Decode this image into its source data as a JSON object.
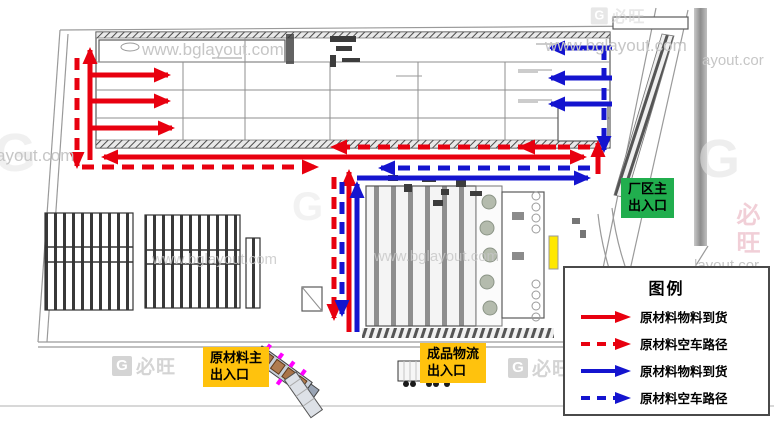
{
  "labels": {
    "main_gate": {
      "line1": "厂区主",
      "line2": "出入口"
    },
    "raw_material_gate": {
      "line1": "原材料主",
      "line2": "出入口"
    },
    "finished_goods_gate": {
      "line1": "成品物流",
      "line2": "出入口"
    }
  },
  "legend": {
    "title": "图例",
    "items": [
      {
        "label": "原材料物料到货",
        "color": "#e8000f",
        "style": "solid"
      },
      {
        "label": "原材料空车路径",
        "color": "#e8000f",
        "style": "dashed"
      },
      {
        "label": "原材料物料到货",
        "color": "#1414cf",
        "style": "solid"
      },
      {
        "label": "原材料空车路径",
        "color": "#1414cf",
        "style": "dashed"
      }
    ]
  },
  "watermarks": {
    "site": "www.bglayout.com",
    "frag_left": "ayout.com",
    "frag_right_top": "ayout.cor",
    "frag_right_mid": "layout.cor",
    "brand": "必旺",
    "brand_g": "G"
  },
  "colors": {
    "route_red": "#e8000f",
    "route_blue": "#1414cf",
    "gate_green": "#21ae4e",
    "label_yellow": "#ffc20d",
    "marker_yellow": "#ffe800"
  }
}
